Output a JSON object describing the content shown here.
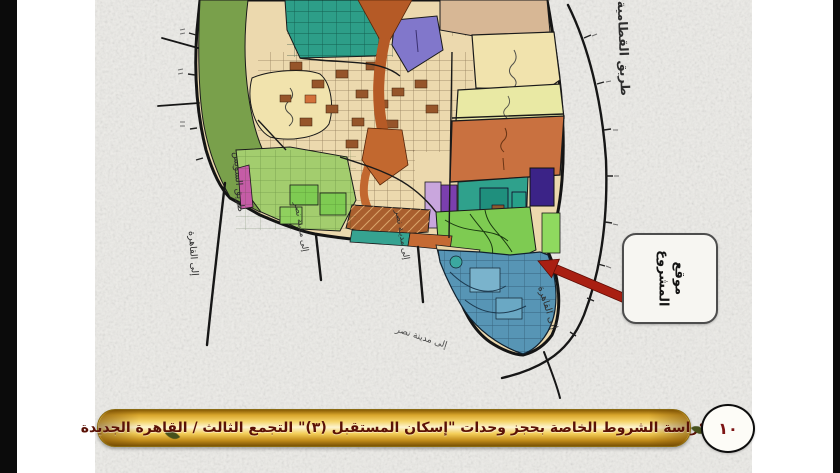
{
  "page": {
    "paper_color": "#edece8",
    "letterbox_color": "#0b0b0b"
  },
  "map": {
    "labels": {
      "right_road": "طريق القطامية - العين السخنة",
      "left_boundary_road": "طريق السويس",
      "to_cairo_left": "إلى القاهرة",
      "to_nasr_city_stub1": "إلى مدينة نصر",
      "to_nasr_city_stub2": "إلى مدينة نصر",
      "to_nasr_city_diagonal": "إلى مدينة نصر",
      "to_cairo_bottom": "إلى القاهرة"
    },
    "colors": {
      "base_beige": "#ecd9ae",
      "teal": "#2d9e88",
      "olive_green": "#79a04b",
      "light_green": "#a3cd6e",
      "lime": "#7ecb52",
      "cream": "#f1e3ad",
      "tan": "#d7b795",
      "yellow_green": "#e9e9a4",
      "orange_block": "#c97140",
      "arterial_orange": "#b55a26",
      "purple": "#8177cb",
      "violet": "#7b3fae",
      "dark_purple": "#3b2387",
      "lavender": "#c9a6dd",
      "magenta": "#c55ca6",
      "brown": "#a95f2e",
      "blue_tip": "#5795b5"
    }
  },
  "callout": {
    "label_line1": "موقع",
    "label_line2": "المشروع",
    "arrow_color": "#a91f12"
  },
  "footer": {
    "title": "كراسة الشروط الخاصة بحجز وحدات \"إسكان المستقبل (٣)\" التجمع الثالث / القاهرة الجديدة",
    "page_number": "١٠",
    "text_color": "#5a1106"
  }
}
